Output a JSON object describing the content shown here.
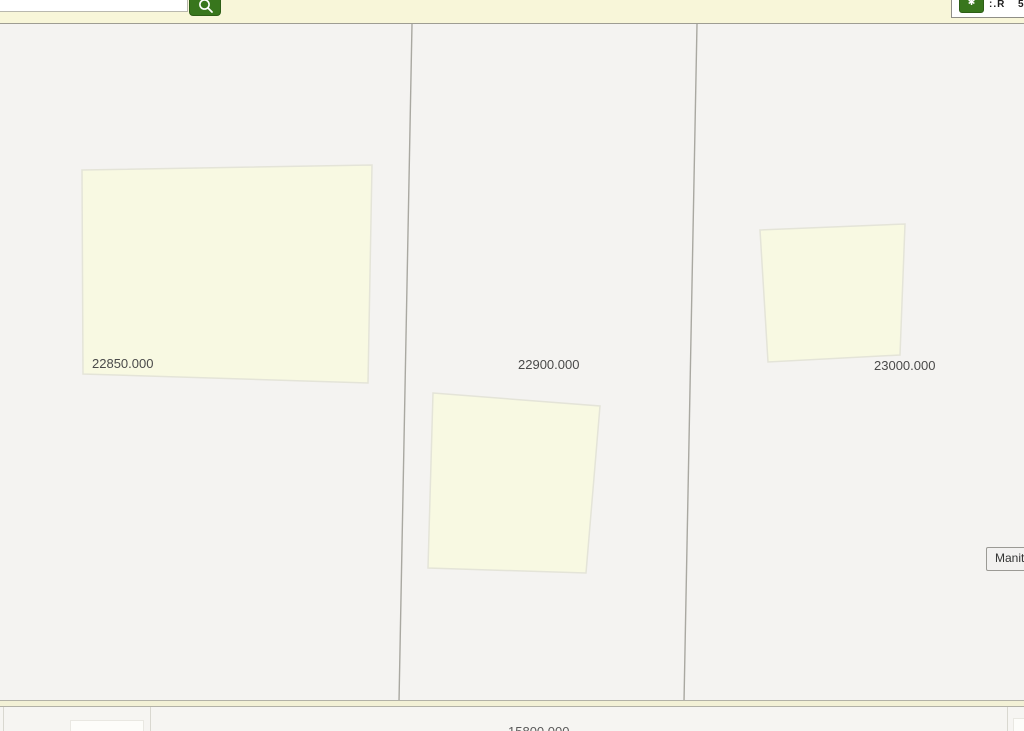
{
  "header": {
    "search": {
      "value": "",
      "placeholder": ""
    },
    "search_button": {
      "icon": "magnifier-icon"
    },
    "tools": {
      "button_icon": "tool-glyph-icon",
      "fragments": [
        ":.R",
        "5"
      ]
    }
  },
  "map": {
    "parcels": [
      {
        "label": "22850.000"
      },
      {
        "label": "22900.000"
      },
      {
        "label": "23000.000"
      }
    ],
    "partial_bottom_label": "15800.000",
    "region_button_label": "Manitoba",
    "colors": {
      "accent_green": "#38761d",
      "parcel_fill": "#f8f9e2",
      "parcel_stroke": "#e4e4d8",
      "boundary_line": "#a9a8a1",
      "header_bg": "#f8f6d9",
      "map_bg": "#f4f3f1",
      "road_fill": "#f3f1d6",
      "label_text": "#4a4a4a"
    }
  }
}
